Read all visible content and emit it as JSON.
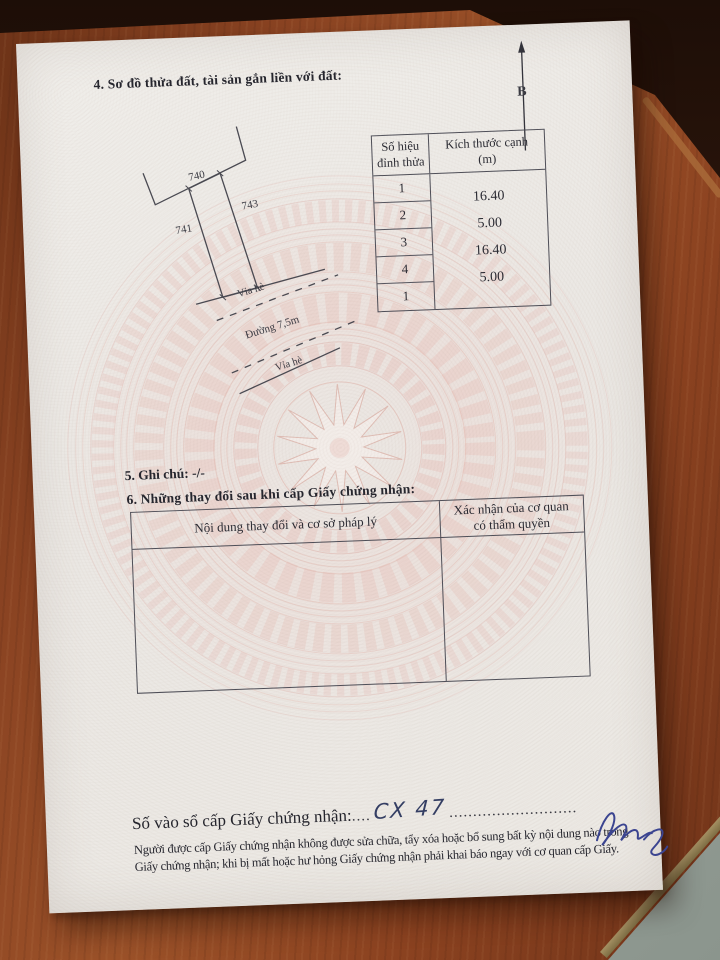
{
  "document": {
    "section4_title": "4. Sơ đồ thửa đất, tài sản gắn liền với đất:",
    "north_arrow_label": "B",
    "diagram": {
      "neighbor_parcel_number": "740",
      "left_parcel_number": "741",
      "right_parcel_number": "743",
      "sidewalk_label_top": "Vỉa hè",
      "road_label": "Đường 7,5m",
      "sidewalk_label_bottom": "Vỉa hè"
    },
    "dimension_table": {
      "col1_header_line1": "Số hiệu",
      "col1_header_line2": "đỉnh thửa",
      "col2_header_line1": "Kích thước cạnh",
      "col2_header_line2": "(m)",
      "vertices": [
        "1",
        "2",
        "3",
        "4",
        "1"
      ],
      "edge_lengths": [
        "16.40",
        "5.00",
        "16.40",
        "5.00"
      ]
    },
    "section5_label": "5. Ghi chú:",
    "section5_value": "-/-",
    "section6_title": "6. Những thay đổi sau khi cấp Giấy chứng nhận:",
    "changes_table": {
      "col1_header": "Nội dung thay đổi và cơ sở pháp lý",
      "col2_header": "Xác nhận của cơ quan có thẩm quyền"
    },
    "footer": {
      "register_label": "Số vào sổ cấp Giấy chứng nhận:",
      "dots_before": "....",
      "register_value": "CX 47",
      "dots_after": "...........................",
      "legal_line1": "Người được cấp Giấy chứng nhận không được sửa chữa, tẩy xóa hoặc bổ sung bất kỳ nội dung nào trong",
      "legal_line2": "Giấy chứng nhận; khi bị mất hoặc hư hỏng Giấy chứng nhận phải khai báo ngay với cơ quan cấp Giấy."
    }
  },
  "colors": {
    "paper": "#ECE9E4",
    "drum_pattern_pink": "#E8C6BF",
    "wood_table": "#8C4524",
    "floor": "#99A29A",
    "ink": "#2B2B33",
    "handwriting_ink": "#343E63",
    "signature_ink": "#3B4490"
  }
}
